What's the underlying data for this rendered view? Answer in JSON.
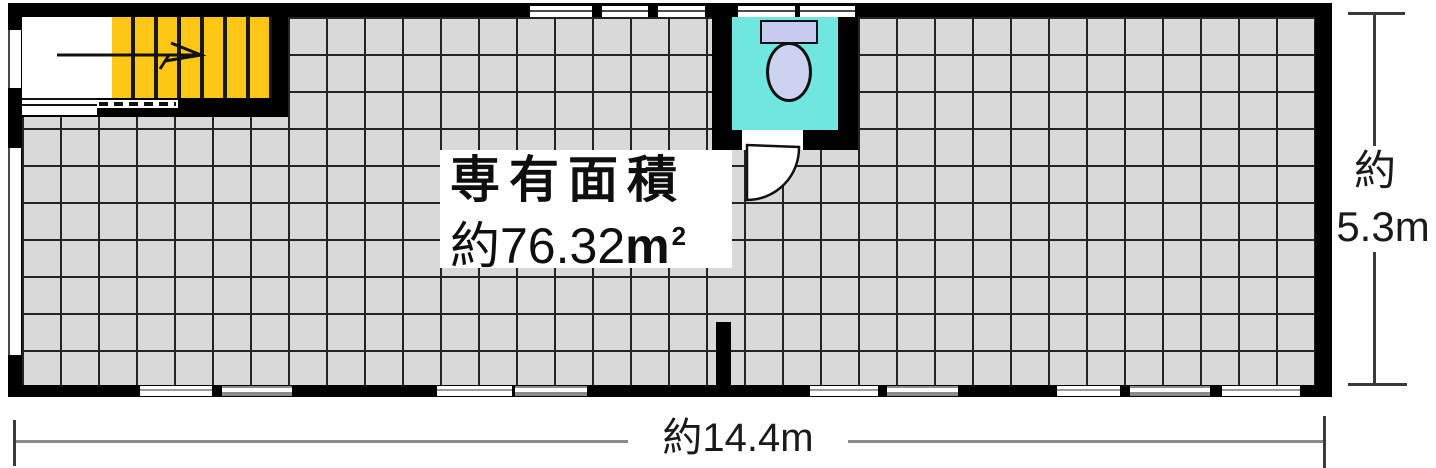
{
  "plan": {
    "type": "floor-plan",
    "area_label": {
      "line1": "専有面積",
      "line2_prefix": "約76.32",
      "unit": "m",
      "unit_sup": "2"
    },
    "icons": {
      "stairs": "staircase-icon",
      "stair_direction": "up-arrow-icon",
      "toilet": "toilet-icon",
      "door": "door-swing-icon",
      "windows": "window-icon"
    },
    "colors": {
      "wall": "#000000",
      "floor_tile": "#d9d9d9",
      "grid_line": "#242424",
      "stair_tread": "#ffc615",
      "toilet_floor": "#70e6e1",
      "toilet_fixture": "#ccd3f1",
      "dimension_line": "#8a8a8a"
    }
  },
  "dimensions": {
    "width": {
      "label": "約14.4m"
    },
    "height": {
      "label_line1": "約",
      "label_line2": "5.3m"
    }
  }
}
